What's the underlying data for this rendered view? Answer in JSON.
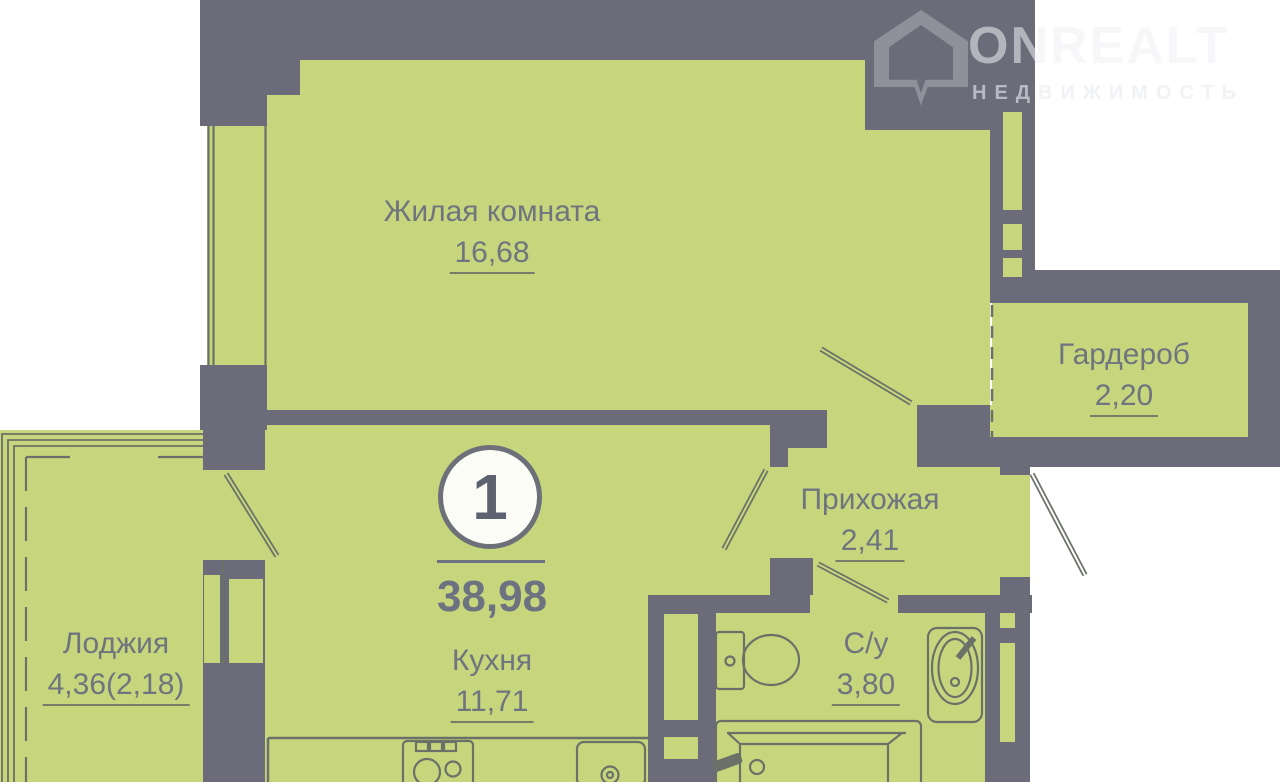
{
  "palette": {
    "wall_color": "#6b6b79",
    "room_color": "#c7d67d",
    "label_color": "#6f747e",
    "outline_color": "#6b7168",
    "background": "#ffffff"
  },
  "logo": {
    "brand": "ONREALT",
    "tagline": "НЕДВИЖИМОСТЬ"
  },
  "plan": {
    "type": "floorplan",
    "badge": {
      "room_count": "1",
      "total_area": "38,98"
    },
    "rooms": [
      {
        "name": "Жилая комната",
        "area": "16,68"
      },
      {
        "name": "Гардероб",
        "area": "2,20"
      },
      {
        "name": "Прихожая",
        "area": "2,41"
      },
      {
        "name": "Лоджия",
        "area": "4,36(2,18)"
      },
      {
        "name": "Кухня",
        "area": "11,71"
      },
      {
        "name": "С/у",
        "area": "3,80"
      }
    ]
  }
}
